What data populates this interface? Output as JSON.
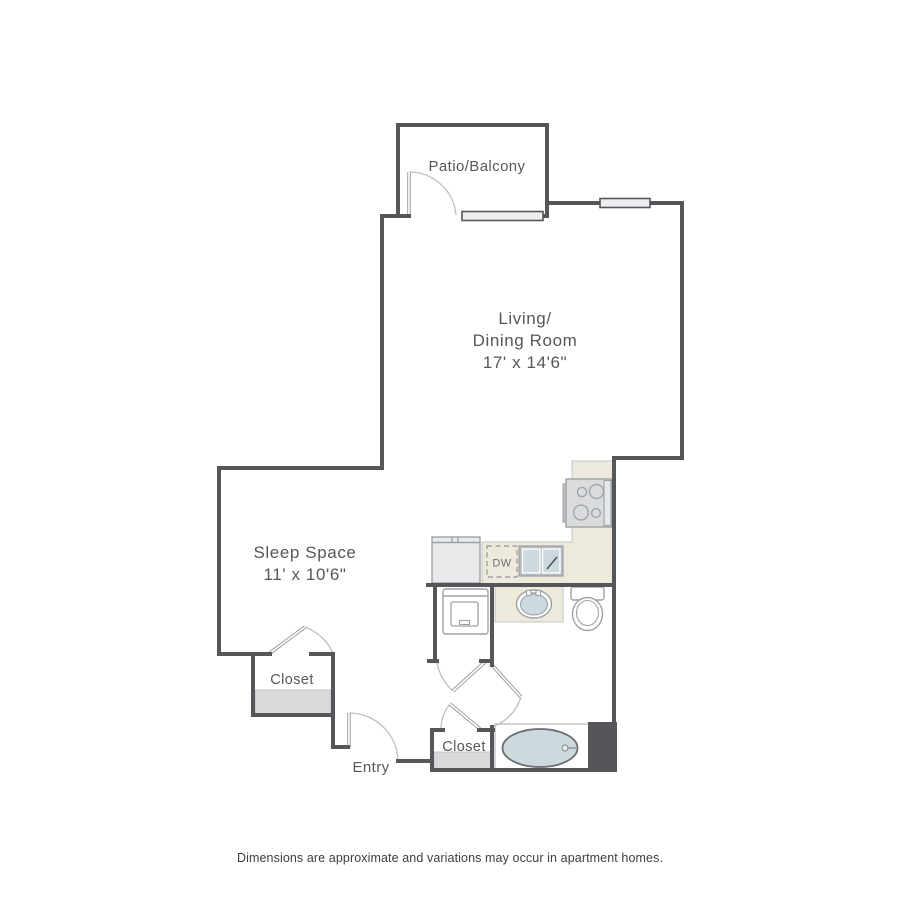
{
  "floor_plan": {
    "title": "studio apartment floor plan",
    "rooms": {
      "patio": {
        "label": "Patio/Balcony"
      },
      "living": {
        "line1": "Living/",
        "line2": "Dining Room",
        "dims": "17' x 14'6\""
      },
      "sleep": {
        "label": "Sleep Space",
        "dims": "11' x 10'6\""
      },
      "closet_left": {
        "label": "Closet"
      },
      "closet_bottom": {
        "label": "Closet"
      },
      "entry": {
        "label": "Entry"
      },
      "dishwasher": {
        "label": "DW"
      }
    },
    "footer": {
      "disclaimer": "Dimensions are approximate and variations may occur in apartment homes."
    },
    "colors": {
      "wall": "#54565A",
      "counter_beige": "#EDEADB",
      "fixture_blue": "#CCDAE0",
      "fixture_stroke": "#9EA2A6",
      "shelf_gray": "#D8D9DB",
      "window_fill": "#ECEEF0",
      "text": "#55575C"
    }
  }
}
